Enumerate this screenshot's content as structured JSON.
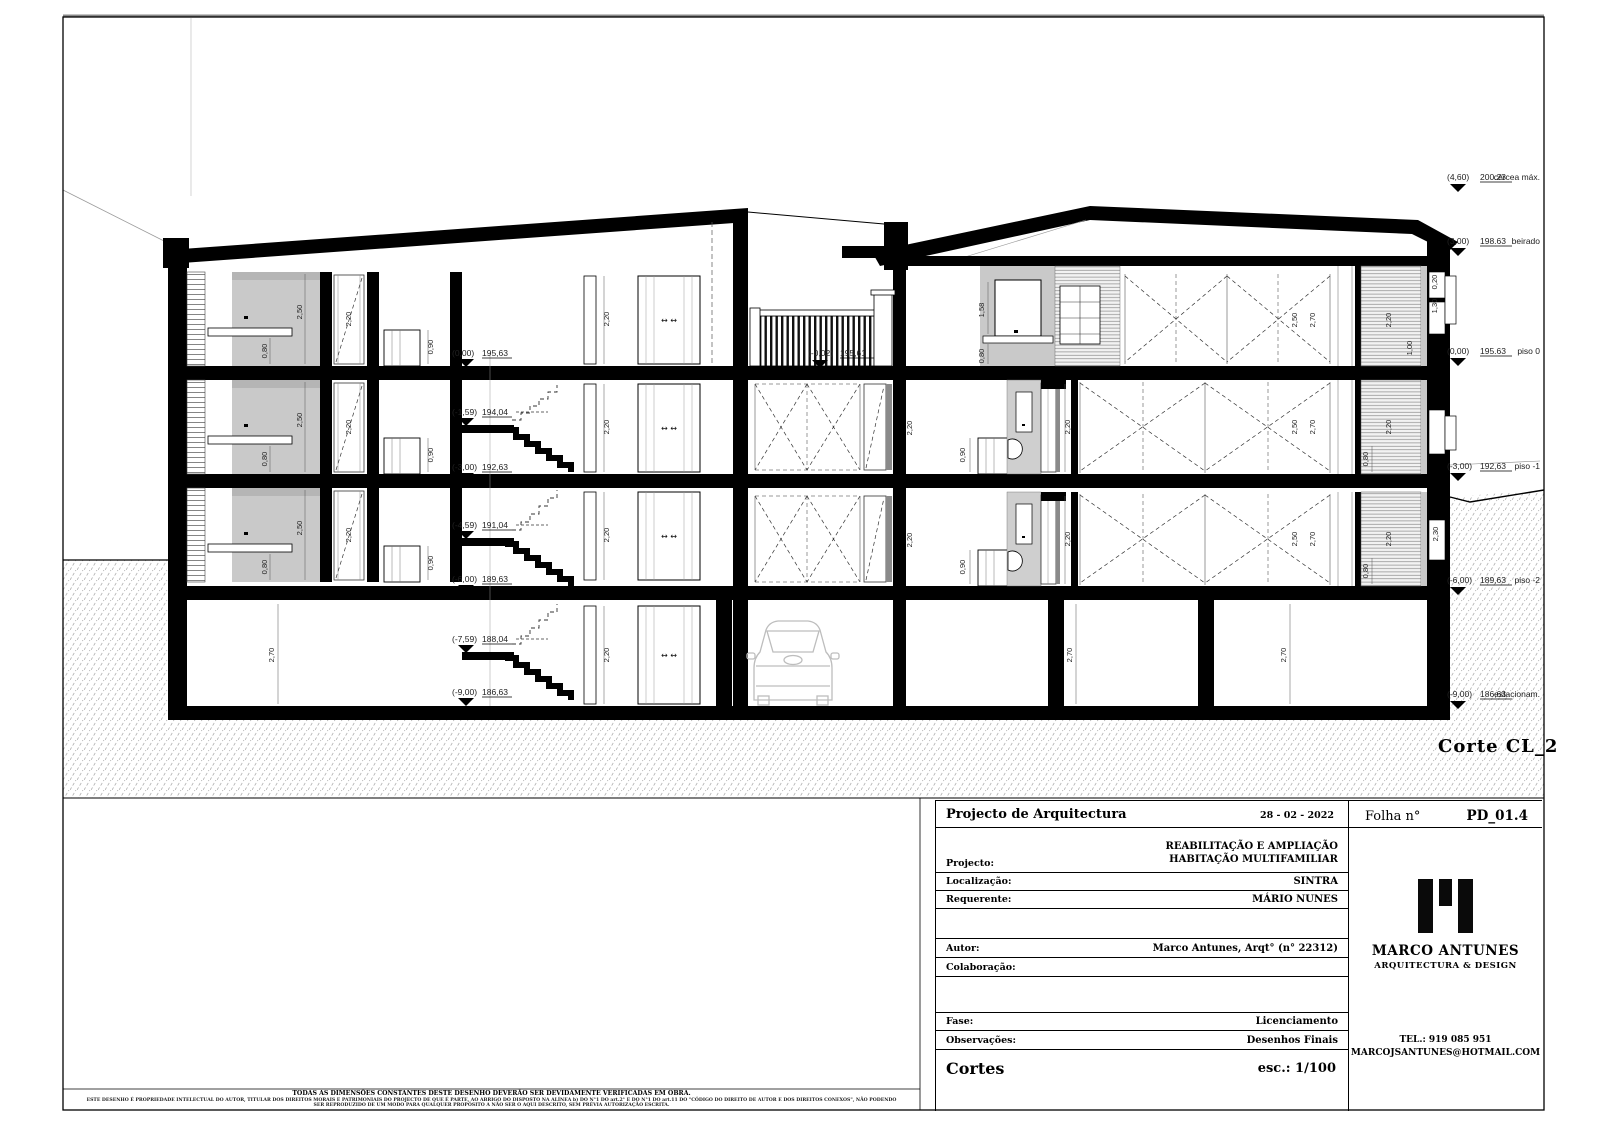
{
  "sheet": {
    "section_label": "Corte CL_2"
  },
  "drawing": {
    "stair_levels": [
      {
        "value": "(0,00)",
        "elev": "195,63"
      },
      {
        "value": "(-1,59)",
        "elev": "194,04"
      },
      {
        "value": "(-3,00)",
        "elev": "192,63"
      },
      {
        "value": "(-4,59)",
        "elev": "191,04"
      },
      {
        "value": "(-6,00)",
        "elev": "189,63"
      },
      {
        "value": "(-7,59)",
        "elev": "188,04"
      },
      {
        "value": "(-9,00)",
        "elev": "186,63"
      }
    ],
    "mid_level": {
      "value": "(-0,02)",
      "elev": "195,61"
    },
    "margin_levels": [
      {
        "value": "(4,60)",
        "elev": "200.23",
        "name": "cércea máx."
      },
      {
        "value": "(3,00)",
        "elev": "198.63",
        "name": "beirado"
      },
      {
        "value": "(0,00)",
        "elev": "195.63",
        "name": "piso 0"
      },
      {
        "value": "(-3,00)",
        "elev": "192,63",
        "name": "piso -1"
      },
      {
        "value": "(-6,00)",
        "elev": "189,63",
        "name": "piso -2"
      },
      {
        "value": "(-9,00)",
        "elev": "186,63",
        "name": "estacionam."
      }
    ],
    "dims": {
      "h250": "2,50",
      "h270": "2,70",
      "h220": "2,20",
      "h230": "2,30",
      "h158": "1,58",
      "h130": "1,30",
      "h100": "1,00",
      "h090": "0,90",
      "h080": "0,80",
      "h020": "0,20",
      "arrows": "↔ ↔"
    }
  },
  "titleblock": {
    "header": "Projecto de Arquitectura",
    "date": "28 - 02 - 2022",
    "folha_label": "Folha n°",
    "folha_value": "PD_01.4",
    "projecto_label": "Projecto:",
    "projecto_value1": "REABILITAÇÃO E AMPLIAÇÃO",
    "projecto_value2": "HABITAÇÃO MULTIFAMILIAR",
    "localizacao_label": "Localização:",
    "localizacao_value": "SINTRA",
    "requerente_label": "Requerente:",
    "requerente_value": "MÁRIO NUNES",
    "autor_label": "Autor:",
    "autor_value": "Marco Antunes, Arqt°  (n° 22312)",
    "colaboracao_label": "Colaboração:",
    "colaboracao_value": "",
    "fase_label": "Fase:",
    "fase_value": "Licenciamento",
    "observacoes_label": "Observações:",
    "observacoes_value": "Desenhos Finais",
    "drawing_title": "Cortes",
    "scale": "esc.: 1/100"
  },
  "logo": {
    "name": "MARCO ANTUNES",
    "tagline": "ARQUITECTURA & DESIGN",
    "tel": "TEL.: 919 085 951",
    "email": "MARCOJSANTUNES@HOTMAIL.COM"
  },
  "footer": {
    "line1": "TODAS AS DIMENSÕES CONSTANTES DESTE DESENHO DEVERÃO SER DEVIDAMENTE VERIFICADAS EM OBRA.",
    "line2": "ESTE DESENHO É PROPRIEDADE INTELECTUAL DO AUTOR, TITULAR DOS DIREITOS MORAIS E PATRIMONIAIS DO PROJECTO DE QUE É PARTE, AO ABRIGO DO DISPOSTO NA ALÍNEA b) DO N°1 DO art.2° E DO N°1 DO art.11 DO \"CÓDIGO DO DIREITO DE AUTOR E DOS DIREITOS CONEXOS\", NÃO PODENDO SER REPRODUZIDO DE UM MODO PARA QUALQUER PROPÓSITO A NÃO SER O AQUI DESCRITO, SEM PRÉVIA AUTORIZAÇÃO ESCRITA."
  }
}
